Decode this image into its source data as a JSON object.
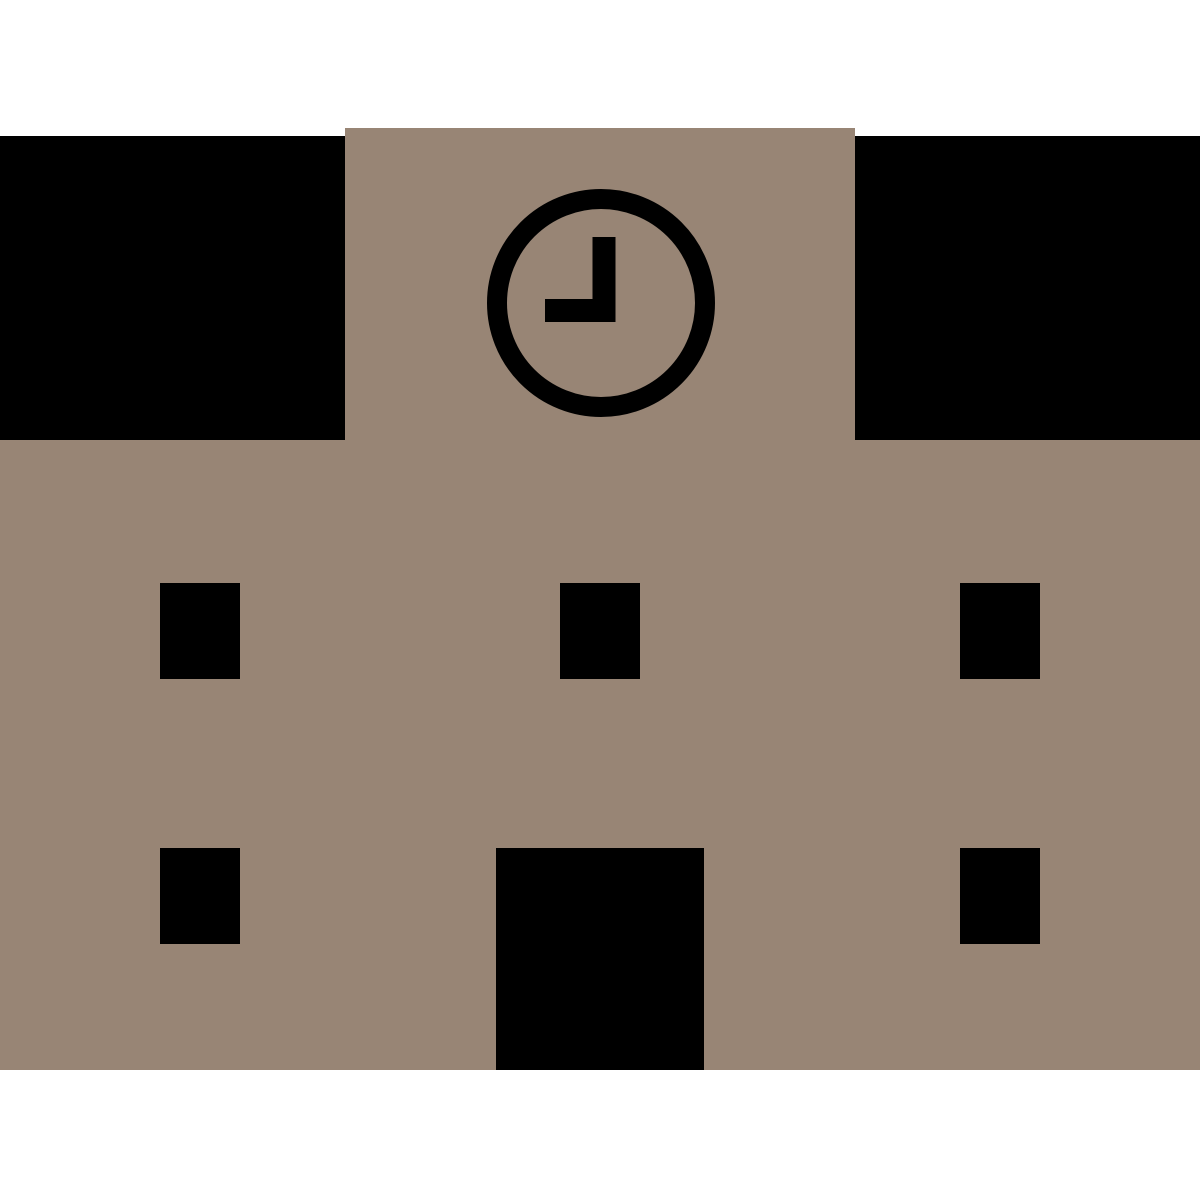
{
  "icon": {
    "name": "school-building",
    "kind": "flat pictogram",
    "parts": {
      "roof_blocks": 2,
      "windows_count": 5,
      "door_count": 1,
      "clock": {
        "minute_hand": "pointing up (12)",
        "hour_hand": "pointing left (9)"
      }
    }
  },
  "colors": {
    "background": "#ffffff",
    "facade": "#988575",
    "detail": "#000000"
  }
}
